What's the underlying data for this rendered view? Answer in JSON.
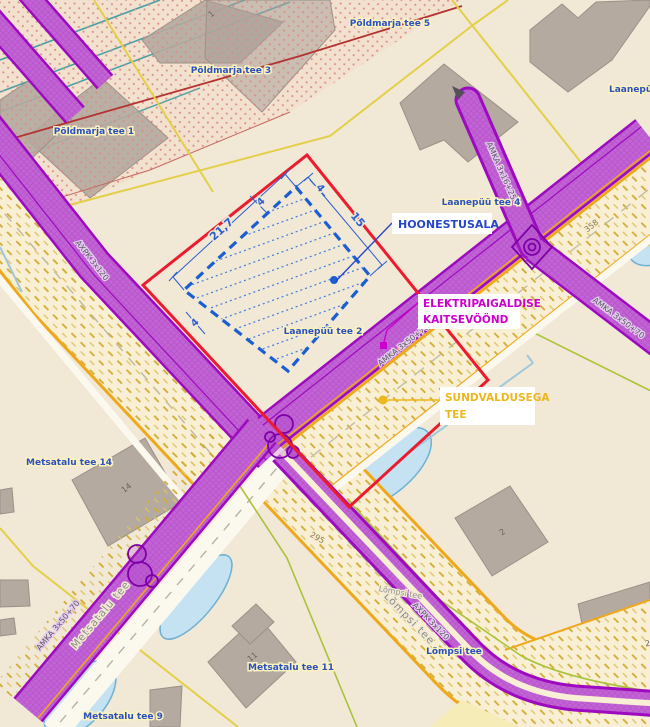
{
  "callouts": {
    "hoonestusala": {
      "label": "HOONESTUSALA"
    },
    "kaitsevoond": {
      "line1": "ELEKTRIPAIGALDISE",
      "line2": "KAITSEVÖÖND"
    },
    "sundvaldus": {
      "line1": "SUNDVALDUSEGA",
      "line2": "TEE"
    }
  },
  "dimensions": {
    "d_long": "21,7",
    "d_short": "15",
    "d_off_top_left": "4",
    "d_off_top_right": "4",
    "d_off_left": "4"
  },
  "parcel_labels": [
    {
      "text": "Põldmarja tee 5"
    },
    {
      "text": "Põldmarja tee 3"
    },
    {
      "text": "Põldmarja tee 1"
    },
    {
      "text": "Laanepüü tee"
    },
    {
      "text": "Laanepüü tee 4"
    },
    {
      "text": "Laanepüü tee 2"
    },
    {
      "text": "Metsatalu tee 14"
    },
    {
      "text": "Metsatalu tee 11"
    },
    {
      "text": "Metsatalu tee 9"
    },
    {
      "text": "Lõmpsi tee"
    }
  ],
  "road_labels": [
    {
      "text": "Metsatalu tee"
    },
    {
      "text": "Lõmpsi tee"
    },
    {
      "text": "Lõmpsi tee"
    }
  ],
  "route_numbers": [
    {
      "text": "358"
    },
    {
      "text": "295"
    }
  ],
  "cable_labels": [
    {
      "text": "AMKA 3x16+25"
    },
    {
      "text": "AMKA 3x50+70"
    },
    {
      "text": "AMKA 3x50+70"
    },
    {
      "text": "AMKA 3x50+70"
    },
    {
      "text": "AXPK 3x120"
    },
    {
      "text": "AXPK 3x120"
    }
  ],
  "building_numbers": [
    {
      "text": "1"
    },
    {
      "text": "14"
    },
    {
      "text": "11"
    },
    {
      "text": "2"
    },
    {
      "text": "2"
    }
  ],
  "colors": {
    "plot_boundary": "#ec1c2e",
    "building_area_blue": "#1a5ed2",
    "protection_zone_purple": "#9d0ac0",
    "road_border_orange": "#efa81c",
    "parcel_line_yellow": "#e3cf48",
    "parcel_line_green": "#a9c33b",
    "pond_fill": "#c4e2f2",
    "background": "#f1e8d6"
  }
}
